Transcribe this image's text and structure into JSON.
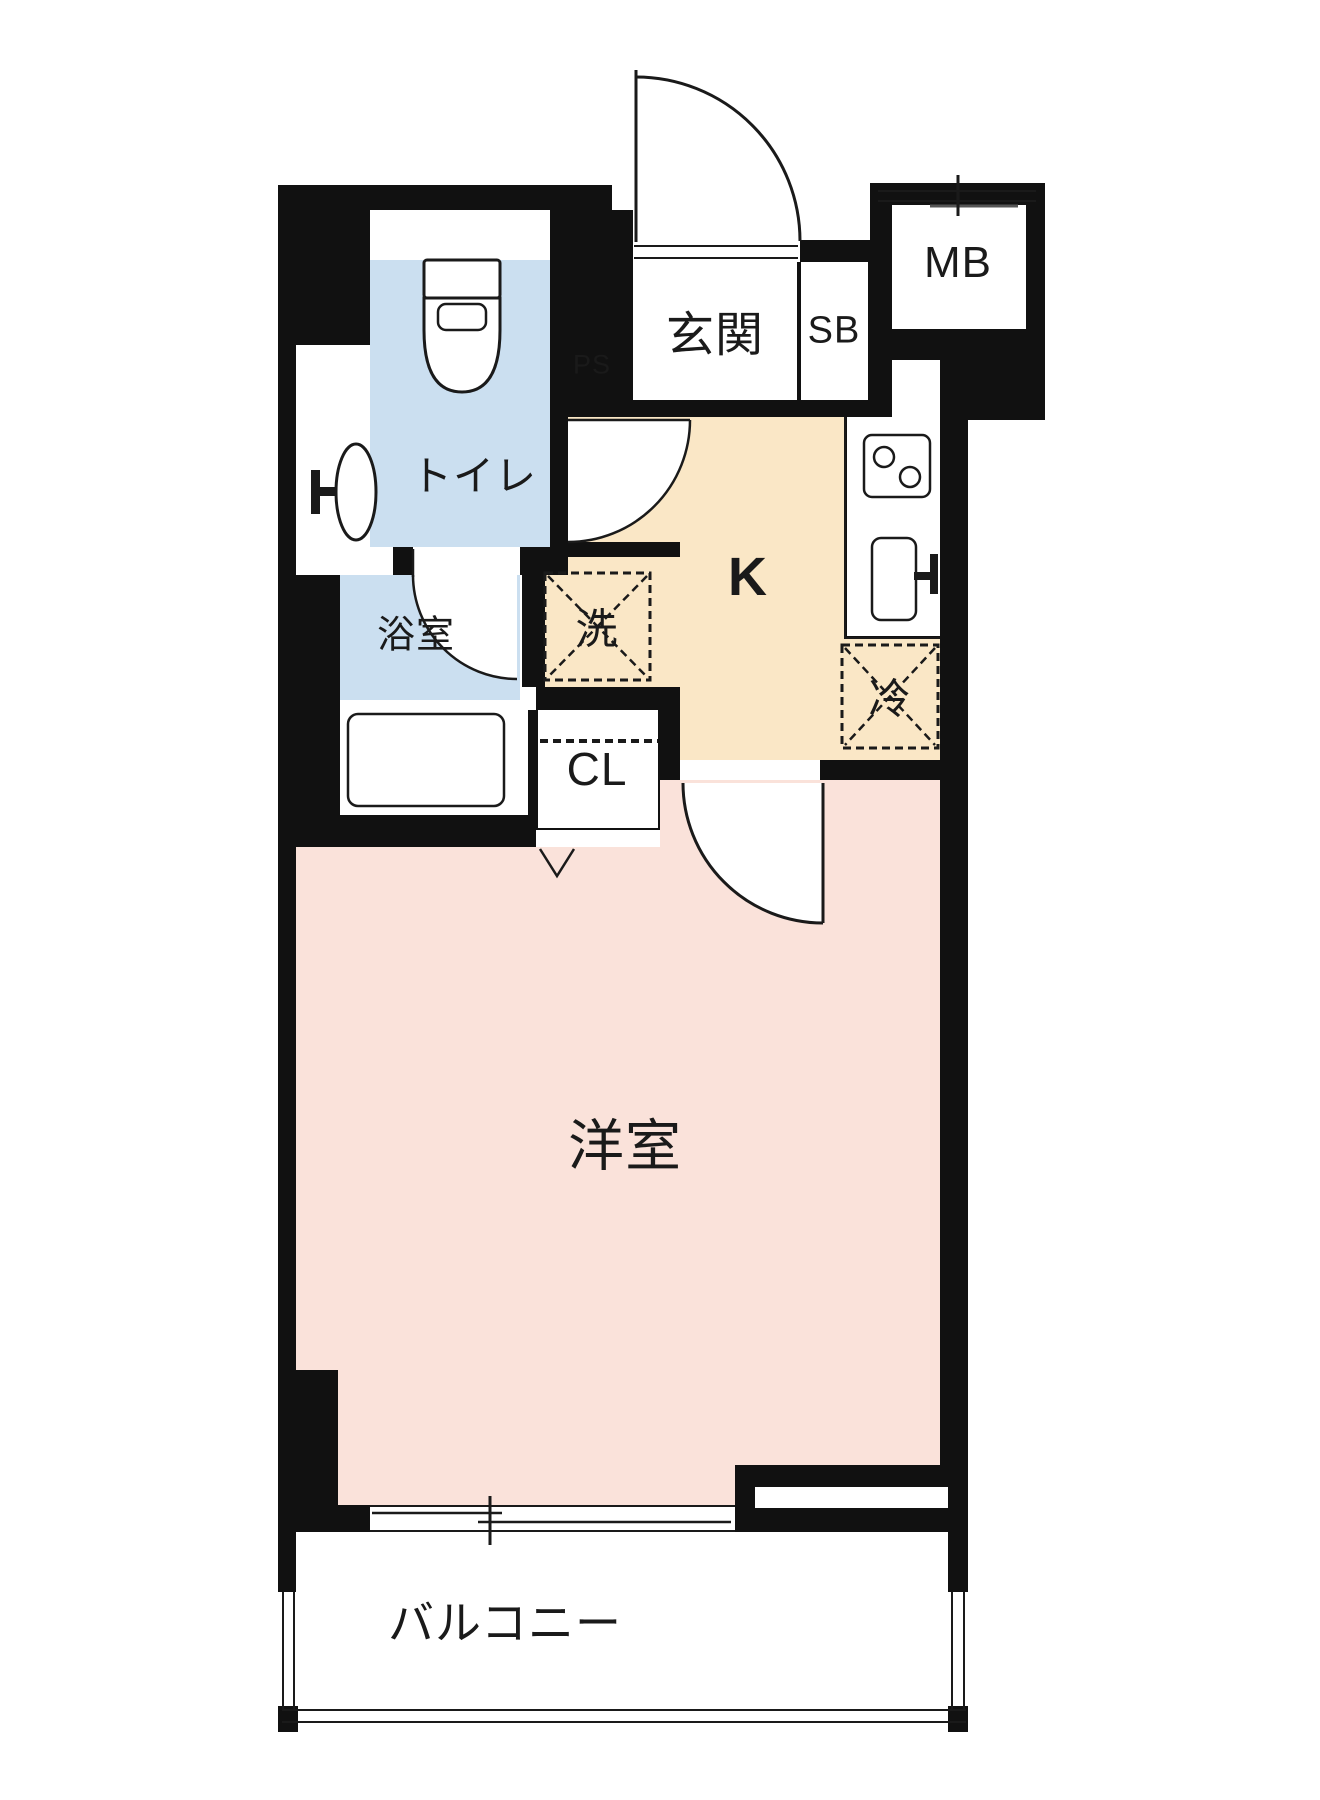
{
  "plan_title": "1K apartment floor plan",
  "colors": {
    "wall": "#111111",
    "line": "#1a1a1a",
    "water": "#cbdff0",
    "kitchen": "#fae7c6",
    "room": "#fae2da"
  },
  "rooms": {
    "genkan": {
      "label": "玄関"
    },
    "shoe_box": {
      "label": "SB"
    },
    "pipe_space": {
      "label": "PS"
    },
    "meter_box": {
      "label": "MB"
    },
    "toilet": {
      "label": "トイレ"
    },
    "bathroom": {
      "label": "浴室"
    },
    "washer": {
      "label": "洗"
    },
    "kitchen": {
      "label": "K"
    },
    "refrigerator": {
      "label": "冷"
    },
    "closet": {
      "label": "CL"
    },
    "western_room": {
      "label": "洋室"
    },
    "balcony": {
      "label": "バルコニー"
    }
  },
  "icons": {
    "toilet-icon": "toilet bowl with tank, plan view",
    "wash-basin-icon": "oval basin with faucet",
    "bathtub-icon": "rounded rectangle tub",
    "stove-icon": "two-burner cooktop",
    "kitchen-sink-icon": "sink with faucet",
    "entrance-door-arc-icon": "quarter-circle door swing",
    "toilet-door-arc-icon": "quarter-circle door swing",
    "bathroom-door-arc-icon": "quarter-circle door swing",
    "room-door-arc-icon": "quarter-circle door swing",
    "washer-hatch-icon": "dashed square with X (washing machine space)",
    "refrigerator-hatch-icon": "dashed square with X (refrigerator space)",
    "closet-fold-mark-icon": "V mark at closet opening",
    "window-icon": "double-line sliding window with tick",
    "mb-window-icon": "double line with tick",
    "balcony-railing-icon": "thin double-line railing"
  }
}
